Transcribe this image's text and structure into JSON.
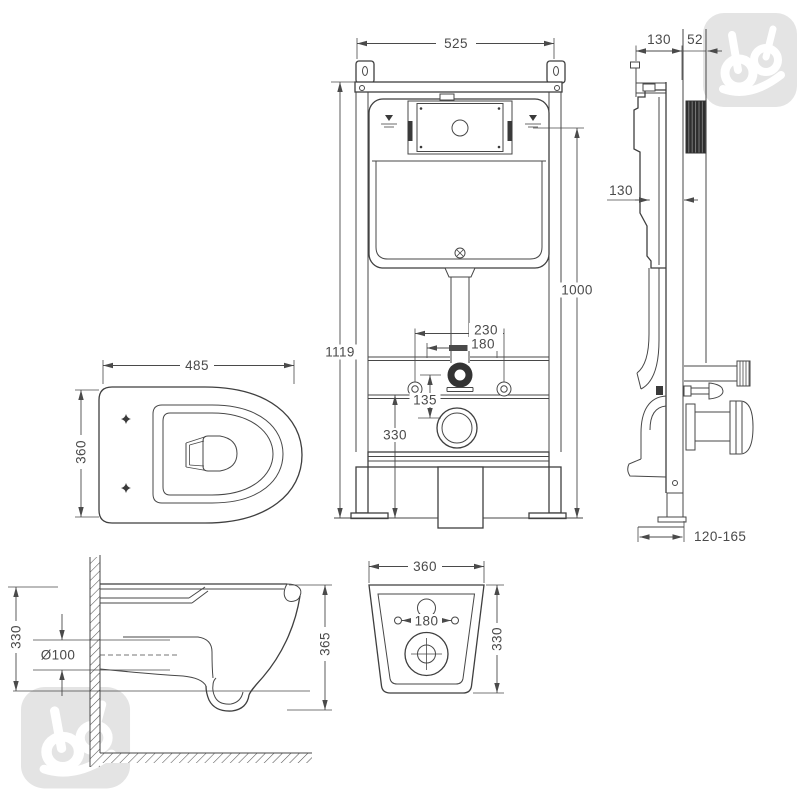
{
  "colors": {
    "line": "#3f3f3f",
    "dim_text": "#4a4a4a",
    "watermark": "#e4e4e4",
    "dark_fill": "#333333",
    "background": "#ffffff"
  },
  "watermark": {
    "icon": "brand-logo-monogram"
  },
  "views": {
    "frame_front": {
      "width": "525",
      "total_height": "1119",
      "water_mark_height": "1000",
      "fixing_bolt_spacing": "230",
      "flush_pipe_spacing": "180",
      "flush_to_drain": "135",
      "bracket_height": "330"
    },
    "frame_side": {
      "frame_depth": "130",
      "wall_plate_depth": "52",
      "cistern_depth": "130",
      "floor_adjust_range": "120-165"
    },
    "pan_top": {
      "width": "485",
      "depth": "360"
    },
    "pan_section": {
      "fixing_height": "330",
      "outlet_diameter": "Ø100",
      "overall_height": "365"
    },
    "pan_back": {
      "width": "360",
      "fixing_hole_spacing": "180",
      "height": "330"
    }
  }
}
